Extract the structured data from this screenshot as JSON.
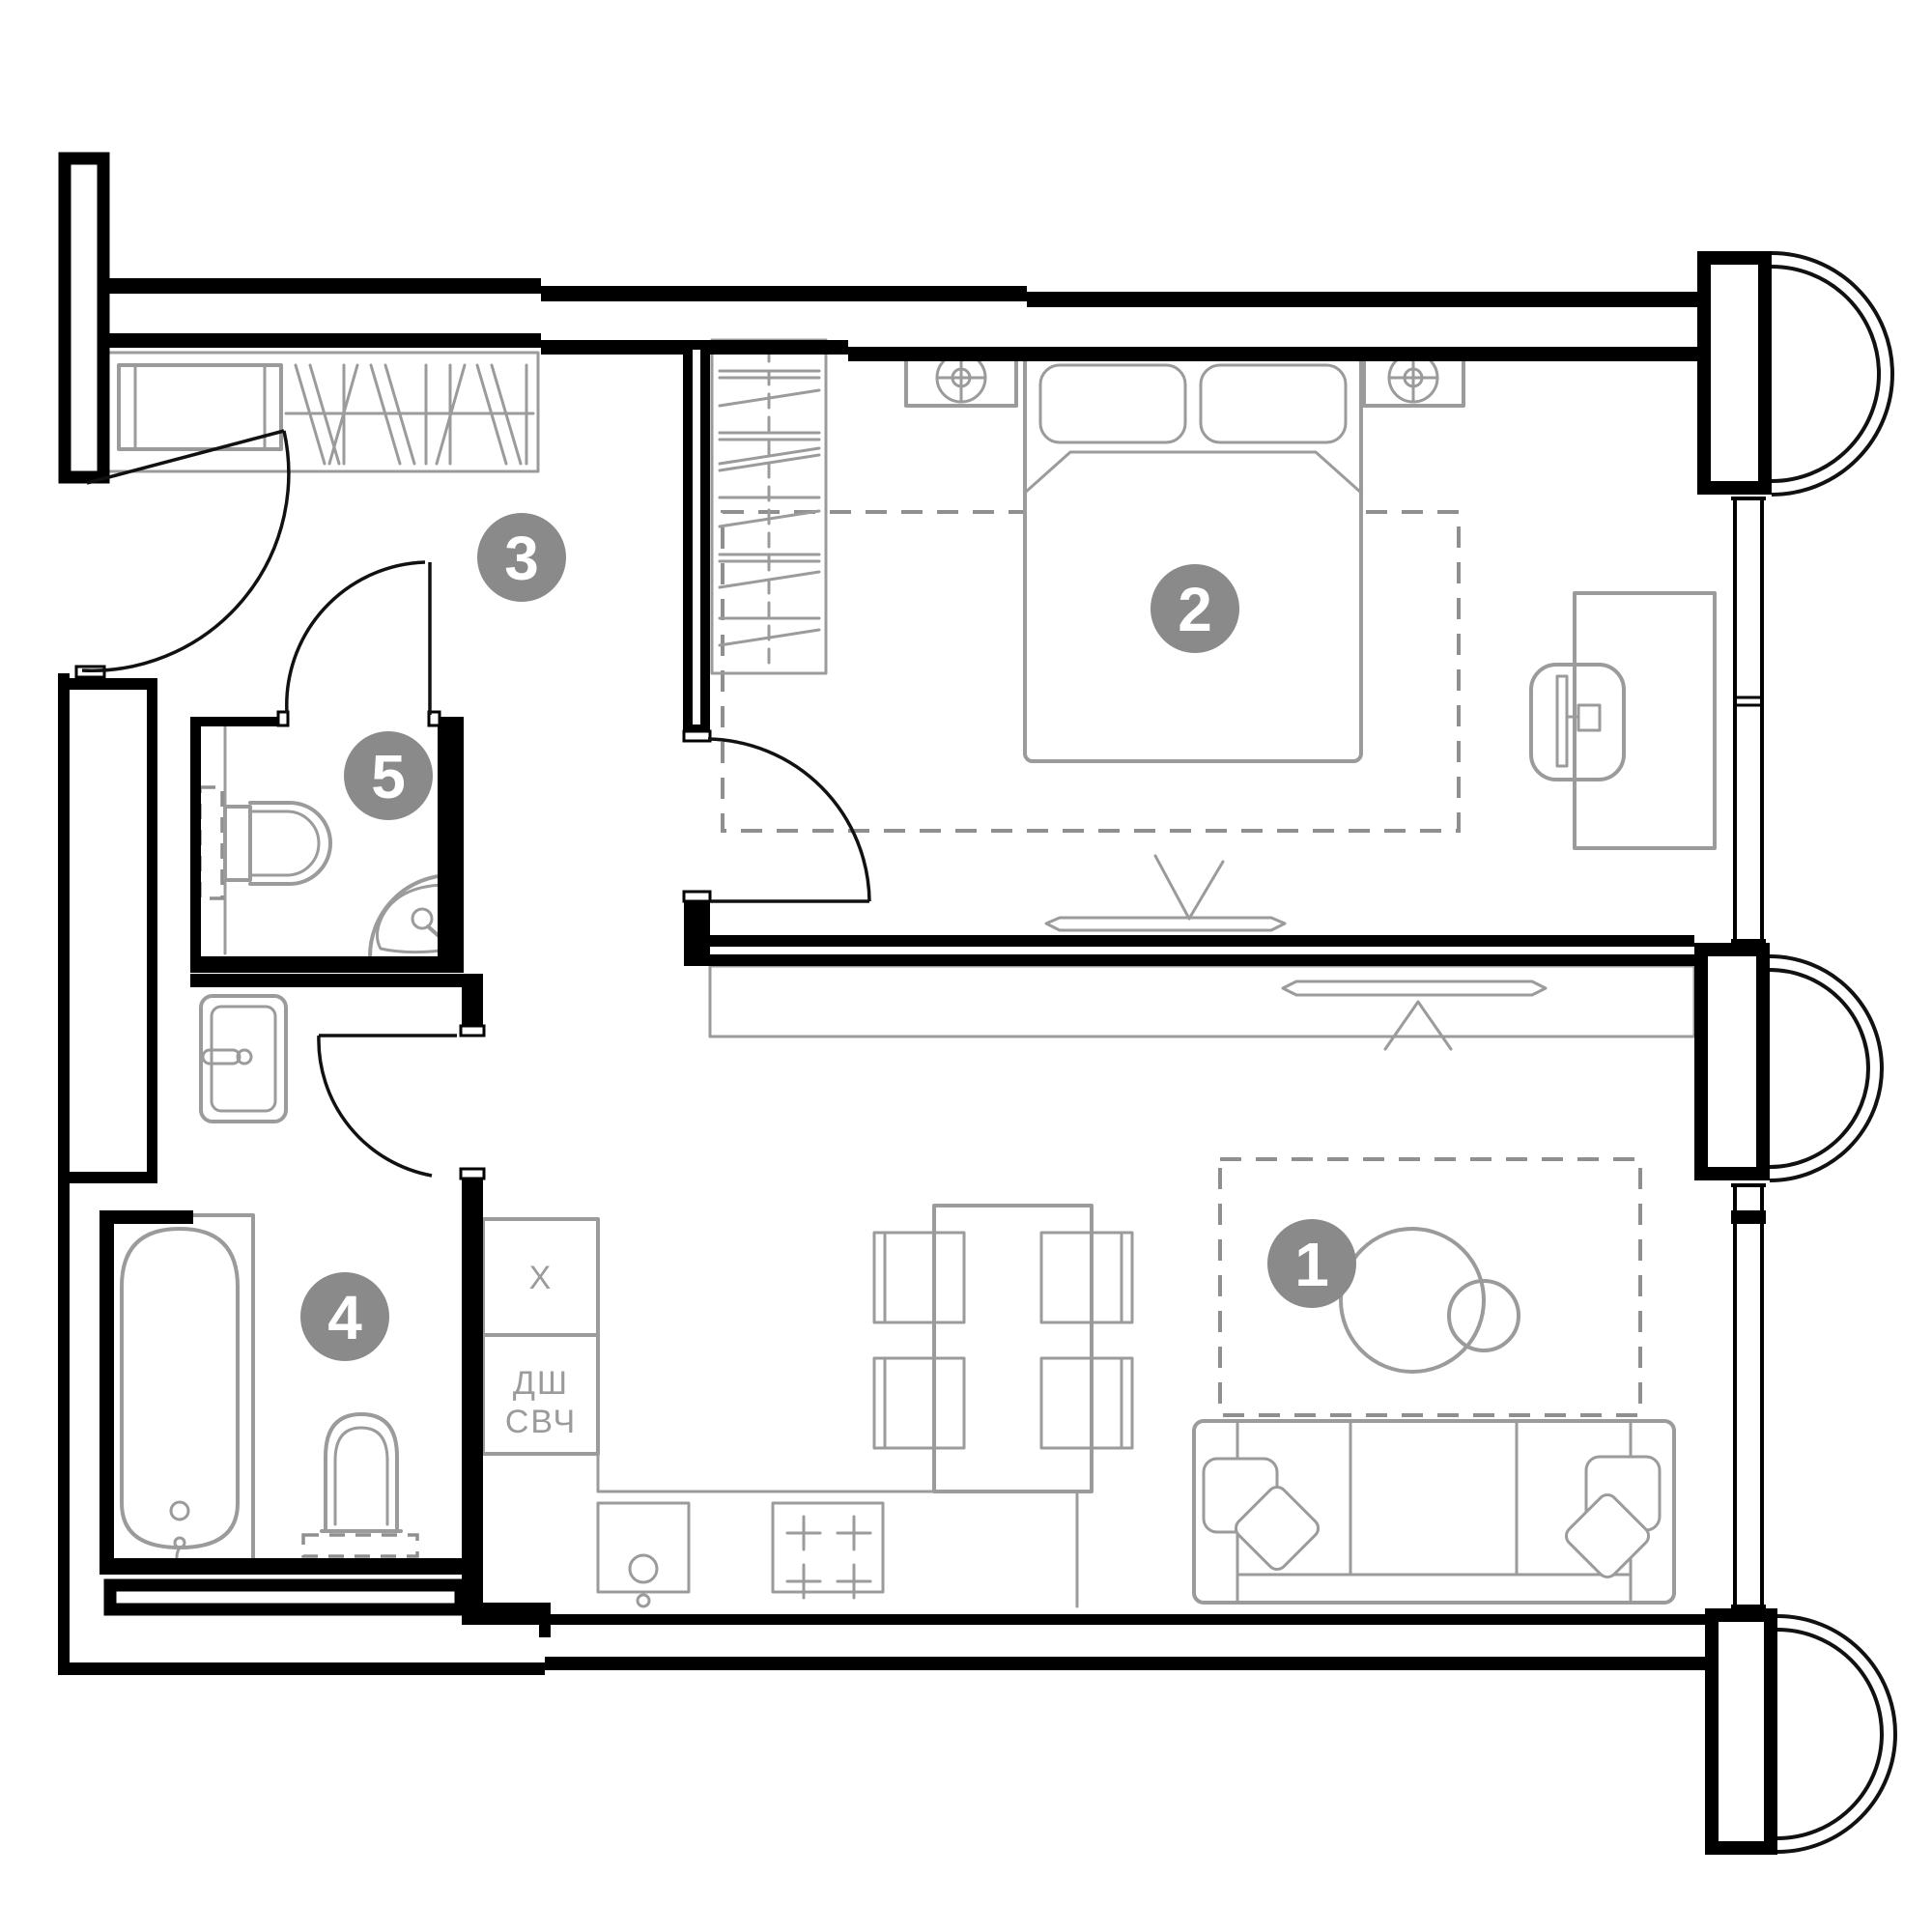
{
  "badges": {
    "living_room": "1",
    "bedroom": "2",
    "hallway": "3",
    "bathroom": "4",
    "wc": "5"
  },
  "kitchen_labels": {
    "fridge": "X",
    "tall_cabinet_line1": "ДШ",
    "tall_cabinet_line2": "СВЧ"
  },
  "colors": {
    "background": "#ffffff",
    "wall": "#000000",
    "furniture": "#9b9b9b",
    "badge_fill": "#8a8a8a",
    "badge_text": "#ffffff",
    "label_text": "#9b9b9b",
    "dash": "#8f8f8f",
    "door": "#111111"
  }
}
